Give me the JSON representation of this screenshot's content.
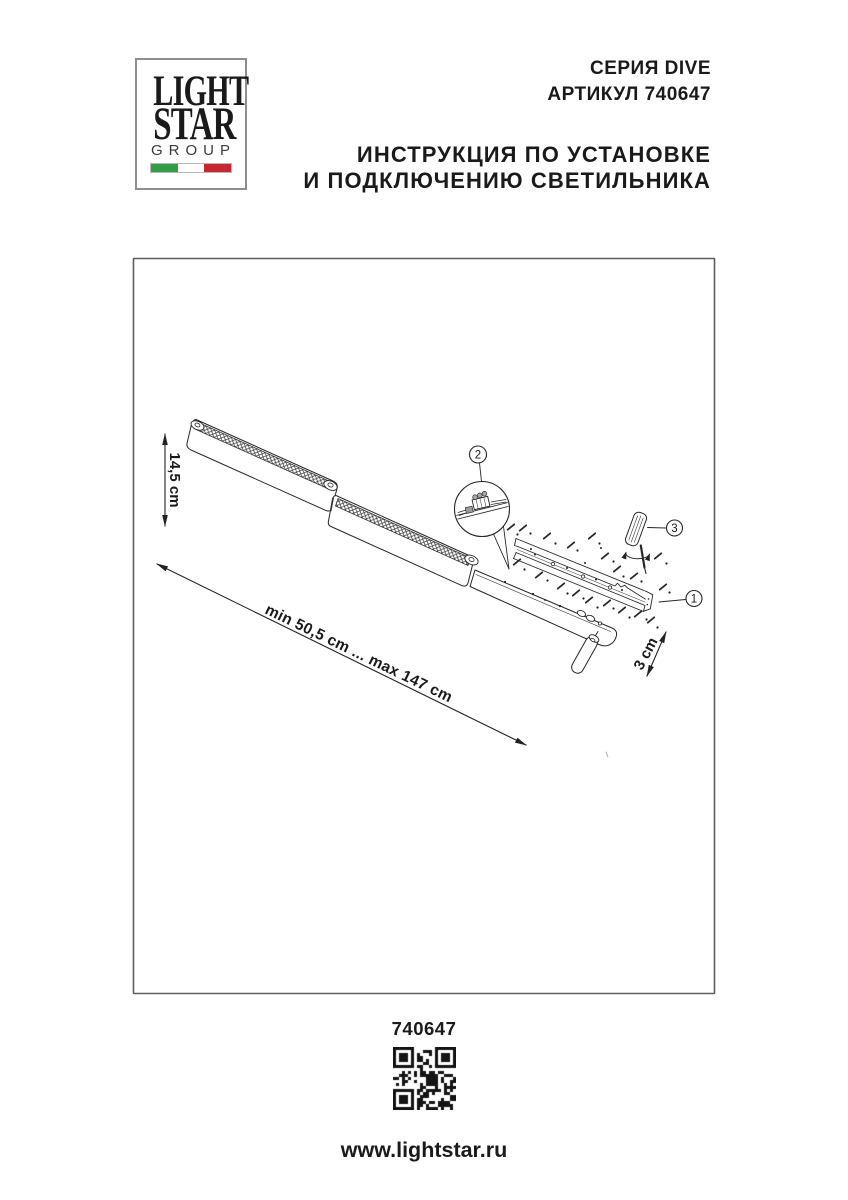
{
  "logo": {
    "word1": "LIGHT",
    "word2": "STAR",
    "word3": "GROUP",
    "flag_colors": {
      "green": "#2f9e44",
      "white": "#ffffff",
      "red": "#c9252c"
    }
  },
  "header": {
    "series": "СЕРИЯ DIVE",
    "article": "АРТИКУЛ 740647",
    "instruction_line1": "ИНСТРУКЦИЯ ПО УСТАНОВКЕ",
    "instruction_line2": "И ПОДКЛЮЧЕНИЮ СВЕТИЛЬНИКА"
  },
  "diagram": {
    "dim_height": "14,5 cm",
    "dim_length": "min 50,5 cm ... max 147 cm",
    "dim_depth": "3 cm",
    "callout_1": "1",
    "callout_2": "2",
    "callout_3": "3"
  },
  "footer": {
    "article": "740647",
    "website": "www.lightstar.ru"
  },
  "colors": {
    "line": "#262626",
    "frame": "#5f5f5f"
  }
}
